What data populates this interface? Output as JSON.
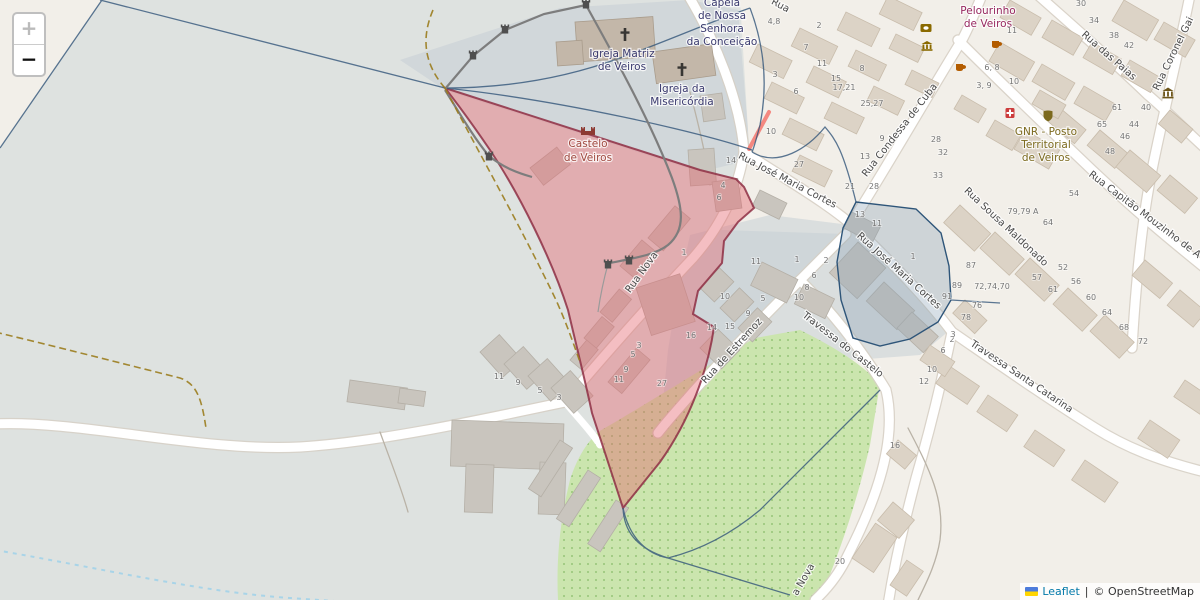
{
  "controls": {
    "zoom_in": "+",
    "zoom_out": "−"
  },
  "attribution": {
    "leaflet": "Leaflet",
    "sep": "|",
    "copyright": "© OpenStreetMap"
  },
  "pois": {
    "capela": [
      "Capela",
      "de Nossa",
      "Senhora",
      "da Conceição"
    ],
    "matriz": [
      "Igreja Matriz",
      "de Veiros"
    ],
    "misericordia": [
      "Igreja da",
      "Misericórdia"
    ],
    "castelo": [
      "Castelo",
      "de Veiros"
    ],
    "pelourinho": [
      "Pelourinho",
      "de Veiros"
    ],
    "gnr": [
      "GNR - Posto",
      "Territorial",
      "de Veiros"
    ]
  },
  "streets": [
    "Rua Nova",
    "Rua José Maria Cortes",
    "Rua José Maria Cortes",
    "Rua de Estremoz",
    "Travessa do Castelo",
    "Rua Condessa de Cuba",
    "Rua das Paias",
    "Rua Coronel Gai",
    "Rua Sousa Maldonado",
    "Rua Capitão Mouzinho de A",
    "Travessa Santa Catarina",
    "a Nova",
    "Rua"
  ],
  "housenumbers": [
    "4,8",
    "2",
    "7",
    "11",
    "8",
    "3",
    "15",
    "17,21",
    "6",
    "25,27",
    "10",
    "9",
    "28",
    "32",
    "13",
    "14",
    "27",
    "33",
    "4",
    "21",
    "28",
    "6",
    "13",
    "11",
    "30",
    "34",
    "38",
    "42",
    "11",
    "6, 8",
    "10",
    "3, 9",
    "61",
    "40",
    "65",
    "44",
    "46",
    "48",
    "54",
    "79,79 A",
    "64",
    "87",
    "89",
    "72,74,70",
    "91",
    "57",
    "52",
    "61",
    "56",
    "60",
    "76",
    "78",
    "2",
    "6",
    "10",
    "12",
    "64",
    "68",
    "72",
    "1",
    "1",
    "2",
    "6",
    "8",
    "10",
    "3",
    "1",
    "11",
    "10",
    "5",
    "9",
    "14",
    "15",
    "16",
    "3",
    "5",
    "9",
    "11",
    "27",
    "11",
    "9",
    "5",
    "3",
    "16",
    "20"
  ],
  "icons": {
    "zoom_in": "plus-icon",
    "zoom_out": "minus-icon",
    "church": "christian-cross-icon",
    "castle": "castle-icon",
    "wall": "tower-icon",
    "atm": "atm-icon",
    "bank": "bank-icon",
    "cafe": "cafe-icon",
    "pharmacy": "pharmacy-icon",
    "police": "police-icon",
    "museum": "museum-icon",
    "flag": "ukraine-flag-icon"
  },
  "colors": {
    "selection_fill": "#e4636e",
    "selection_border": "#8e2f44",
    "boundary": "#33567a",
    "park": "#cbe5ae",
    "road": "#ffffff",
    "leaflet_link": "#0078A8",
    "gray_zone": "#dee2e0"
  }
}
